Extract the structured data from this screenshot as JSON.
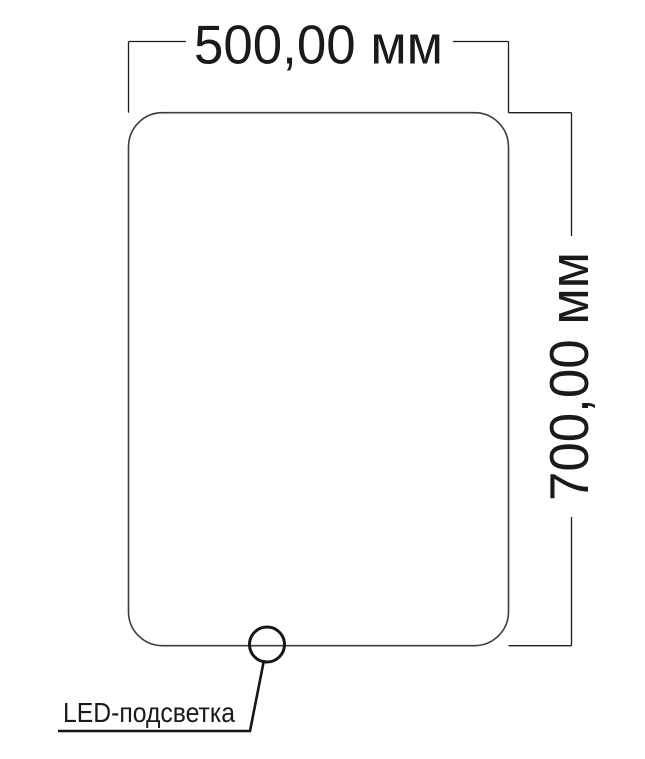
{
  "diagram": {
    "width_label": "500,00 мм",
    "height_label": "700,00 мм",
    "led_label": "LED-подсветка",
    "colors": {
      "background": "#ffffff",
      "outline": "#3d3d3d",
      "dimension": "#1c1c1c",
      "callout": "#161616",
      "text": "#1a1a1a"
    }
  }
}
